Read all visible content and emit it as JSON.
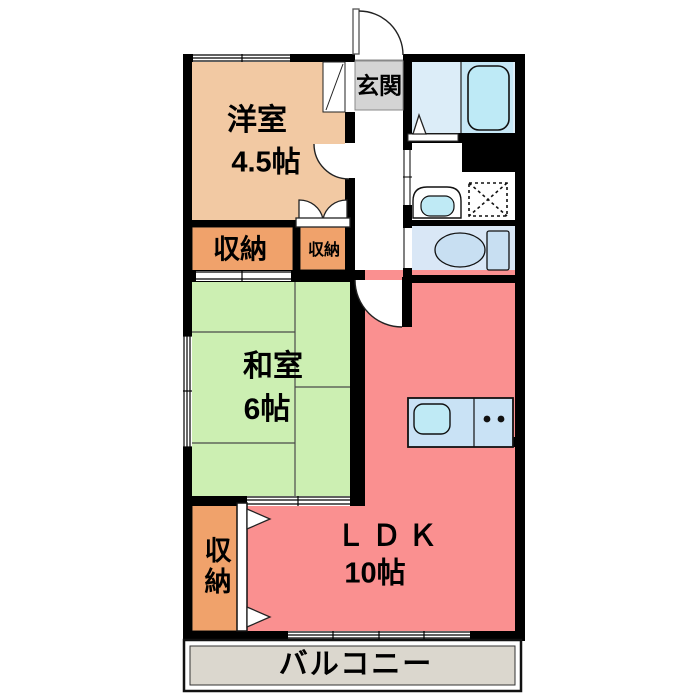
{
  "plan": {
    "title": "apartment-floor-plan",
    "rooms": {
      "yoshitsu": {
        "name": "洋室",
        "size": "4.5帖",
        "color": "#F2C9A3"
      },
      "washitsu": {
        "name": "和室",
        "size": "6帖",
        "color": "#CCEFB2"
      },
      "ldk": {
        "name": "ＬＤＫ",
        "size": "10帖",
        "color": "#FA9090"
      },
      "genkan": {
        "name": "玄関",
        "color": "#D4D4D4"
      },
      "balcony": {
        "name": "バルコニー",
        "color": "#DBD7CE"
      },
      "closet_upper_left": {
        "name": "収納",
        "color": "#F0A26B"
      },
      "closet_upper_right": {
        "name": "収納",
        "color": "#F0A26B"
      },
      "closet_lower": {
        "name": "収納",
        "color": "#F0A26B",
        "orientation": "vertical"
      }
    },
    "fixtures": [
      "bathtub",
      "shower-room-folding-door",
      "washbasin",
      "washing-machine-pan",
      "toilet",
      "kitchen-counter",
      "kitchen-sink",
      "gas-burners",
      "entrance-door-swing",
      "room-door-swing",
      "closet-double-door",
      "closet-triangle-doors",
      "sliding-windows",
      "balcony-sliding-door"
    ],
    "colors": {
      "wall": "#000000",
      "bath_room": "#DCEDF8",
      "bathtub_panel": "#C6E7F6",
      "bathtub": "#BEEAF6",
      "toilet_room": "#D9E7F6",
      "fixture_blue": "#C8DFF2",
      "kitchen_counter": "#C9E2F5",
      "sink": "#BFEAF5",
      "background": "#FFFFFF"
    }
  }
}
